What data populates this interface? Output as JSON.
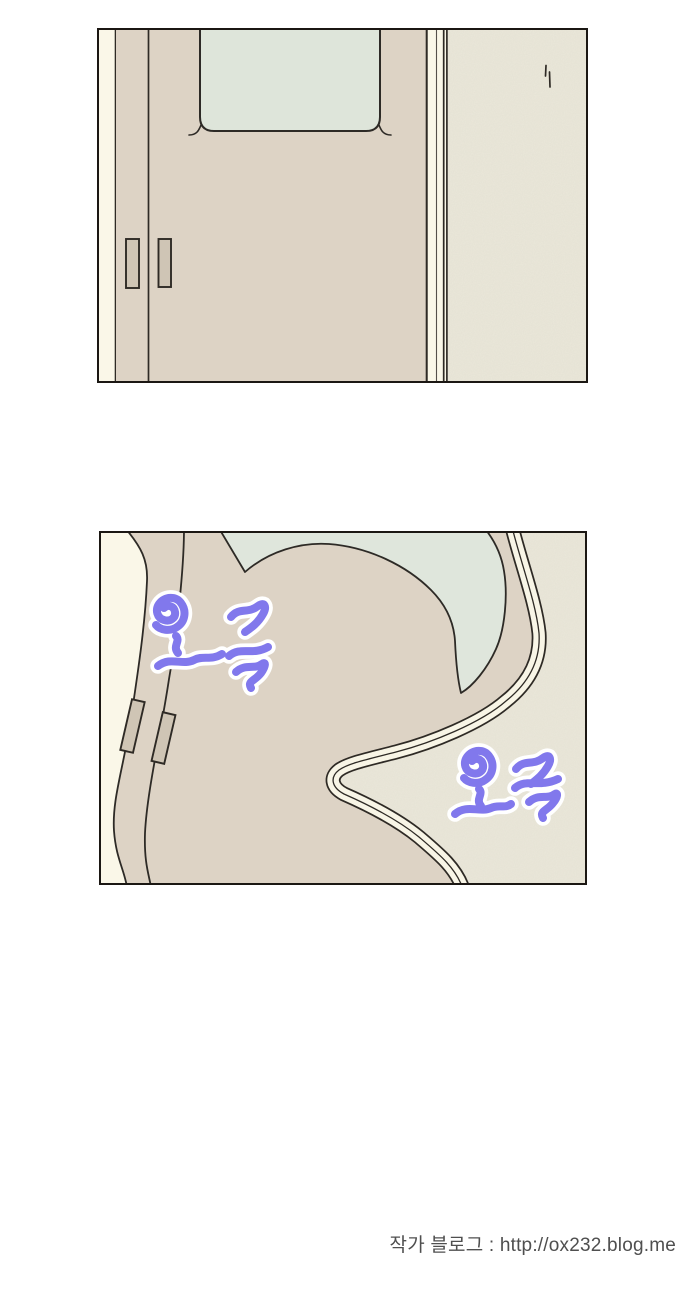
{
  "page": {
    "width": 690,
    "height": 1306,
    "background": "#ffffff"
  },
  "panels": [
    {
      "id": "panel-1",
      "alt": "Closed sliding door with frosted window beside a textured wall",
      "colors": {
        "door": "#ddd3c5",
        "door_jamb_cream": "#faf7e8",
        "window_glass": "#dee5da",
        "wall": "#ebe8da",
        "handle_fill": "#cfc5b5",
        "outline": "#2e2a25"
      }
    },
    {
      "id": "panel-2",
      "alt": "The same door scene warping and wobbling",
      "sound_effects": [
        {
          "text": "오글",
          "color": "#8178ec",
          "outline": "#ffffff",
          "position": "upper-left"
        },
        {
          "text": "오글",
          "color": "#8178ec",
          "outline": "#ffffff",
          "position": "lower-right"
        }
      ],
      "colors": {
        "door": "#ddd3c5",
        "door_jamb_cream": "#faf7e8",
        "window_glass": "#dfe6dc",
        "wall": "#ebe8da",
        "handle_fill": "#cfc5b5",
        "outline": "#2e2a25"
      }
    }
  ],
  "footer": {
    "caption": "작가 블로그 : http://ox232.blog.me",
    "color": "#4f4f4f"
  }
}
